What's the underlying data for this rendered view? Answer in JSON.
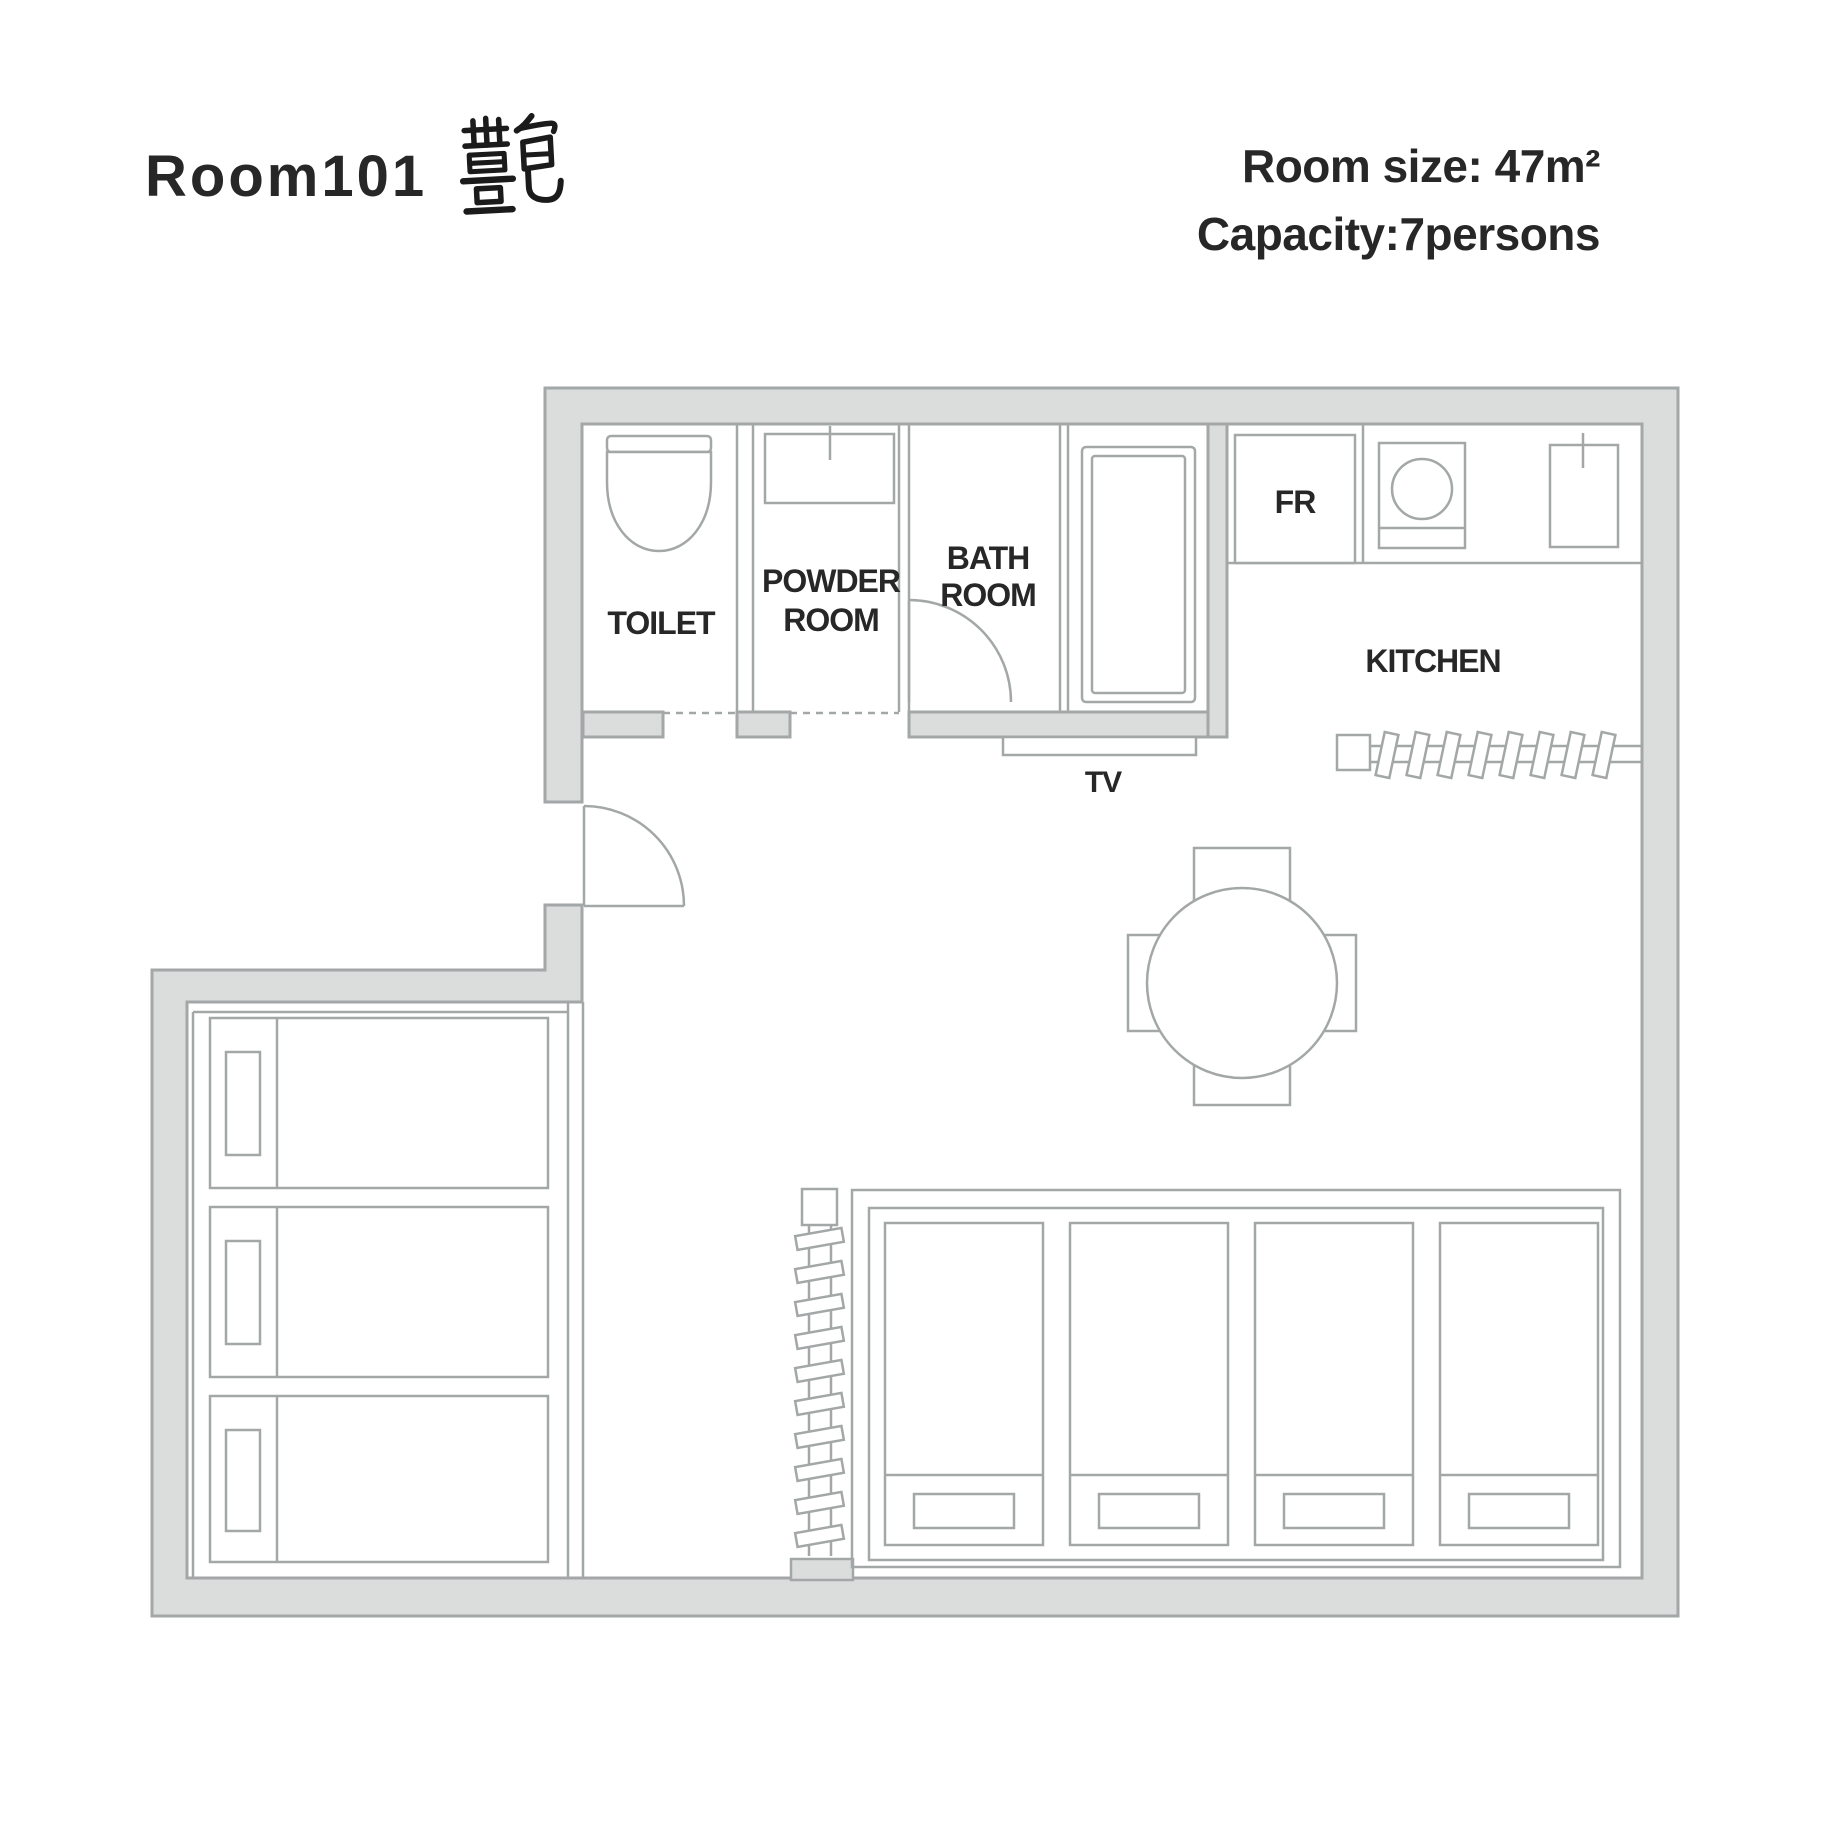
{
  "header": {
    "title": "Room101",
    "calligraphy": "艶",
    "room_size": "Room size: 47m²",
    "capacity": "Capacity:7persons"
  },
  "plan": {
    "labels": {
      "toilet": "TOILET",
      "powder_line1": "POWDER",
      "powder_line2": "ROOM",
      "bath_line1": "BATH",
      "bath_line2": "ROOM",
      "fridge": "FR",
      "kitchen": "KITCHEN",
      "tv": "TV"
    },
    "furniture_icons": [
      "entry-door-swing",
      "toilet-bowl",
      "powder-room-sink",
      "bathroom-door-swing",
      "bathtub",
      "refrigerator",
      "stove-cooktop",
      "kitchen-sink",
      "tv-stand",
      "round-dining-table",
      "four-chairs",
      "horizontal-bunk-ladder",
      "vertical-bunk-ladder",
      "three-single-beds",
      "four-single-beds"
    ],
    "colors": {
      "wall_fill": "#dbdddd",
      "line": "#a3a7a7",
      "text": "#272727"
    }
  }
}
